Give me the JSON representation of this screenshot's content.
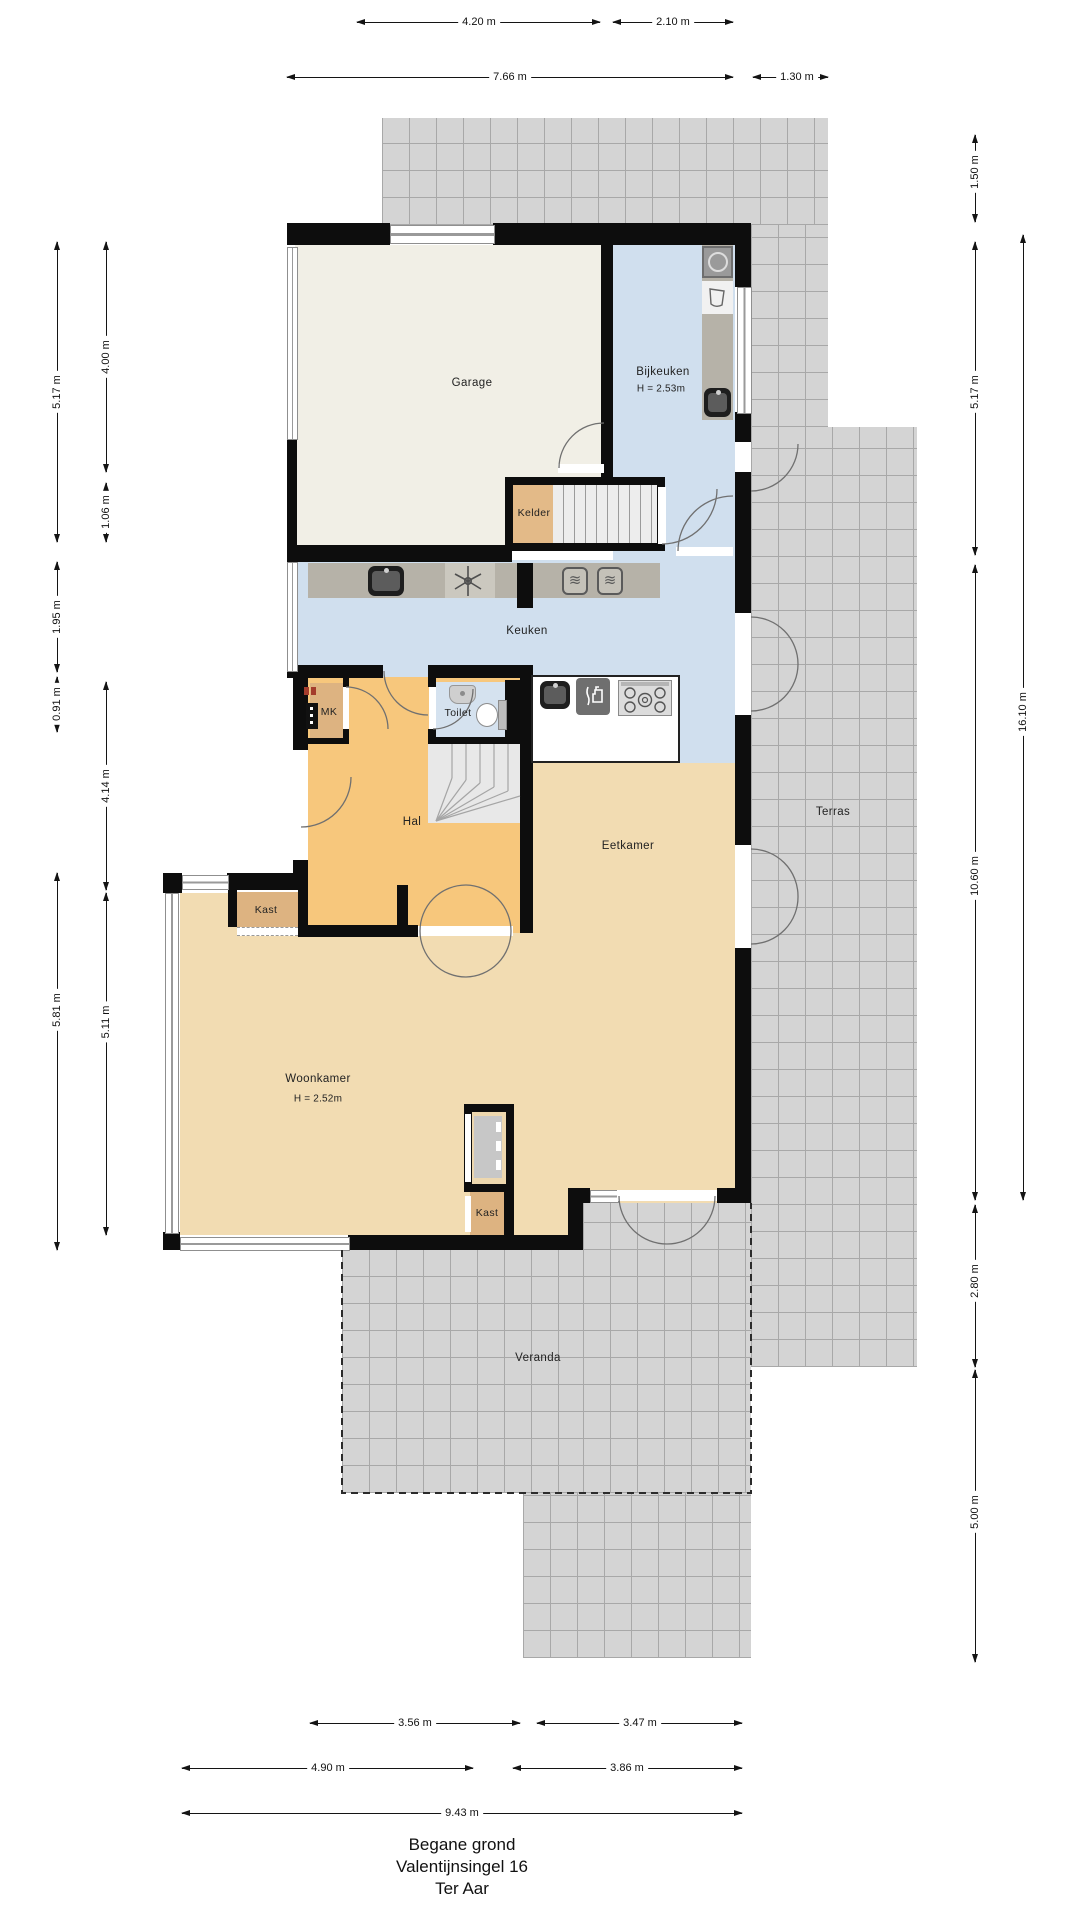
{
  "plan_title": {
    "line1": "Begane grond",
    "line2": "Valentijnsingel 16",
    "line3": "Ter Aar"
  },
  "rooms": {
    "garage": {
      "label": "Garage"
    },
    "bijkeuken": {
      "label": "Bijkeuken",
      "height": "H = 2.53m"
    },
    "kelder": {
      "label": "Kelder"
    },
    "keuken": {
      "label": "Keuken"
    },
    "mk": {
      "label": "MK"
    },
    "toilet": {
      "label": "Toilet"
    },
    "hal": {
      "label": "Hal"
    },
    "kast_hal": {
      "label": "Kast"
    },
    "eetkamer": {
      "label": "Eetkamer"
    },
    "woonkamer": {
      "label": "Woonkamer",
      "height": "H = 2.52m"
    },
    "kast_woonkamer": {
      "label": "Kast"
    },
    "terras": {
      "label": "Terras"
    },
    "veranda": {
      "label": "Veranda"
    }
  },
  "dimensions": {
    "top": [
      {
        "label": "4.20 m"
      },
      {
        "label": "2.10 m"
      },
      {
        "label": "7.66 m"
      },
      {
        "label": "1.30 m"
      }
    ],
    "left": [
      {
        "label": "5.17 m"
      },
      {
        "label": "4.00 m"
      },
      {
        "label": "1.06 m"
      },
      {
        "label": "1.95 m"
      },
      {
        "label": "0.91 m"
      },
      {
        "label": "4.14 m"
      },
      {
        "label": "5.81 m"
      },
      {
        "label": "5.11 m"
      }
    ],
    "right": [
      {
        "label": "1.50 m"
      },
      {
        "label": "5.17 m"
      },
      {
        "label": "16.10 m"
      },
      {
        "label": "10.60 m"
      },
      {
        "label": "2.80 m"
      },
      {
        "label": "5.00 m"
      }
    ],
    "bottom": [
      {
        "label": "3.56 m"
      },
      {
        "label": "3.47 m"
      },
      {
        "label": "4.90 m"
      },
      {
        "label": "3.86 m"
      },
      {
        "label": "9.43 m"
      }
    ]
  },
  "icons": [
    "washing-machine-icon",
    "laundry-basin-icon",
    "sink-icon",
    "oven-icon",
    "oven-icon",
    "extractor-fan-icon",
    "dishwasher-icon",
    "gas-hob-icon",
    "toilet-icon",
    "washbasin-icon",
    "fusebox-icon",
    "fireplace-flue-icon"
  ],
  "colors": {
    "wall": "#0d0d0d",
    "terrace_tile": "#d4d4d4",
    "tile_grid": "#a8a8a8",
    "garage_floor": "#f1efe6",
    "wet_room_blue": "#d0dfee",
    "hall_orange": "#f7c77c",
    "living_tan": "#f2dcb2",
    "closet_tan": "#ddb381",
    "counter_taupe": "#b6b2a8",
    "stairs_grey": "#ececec"
  }
}
